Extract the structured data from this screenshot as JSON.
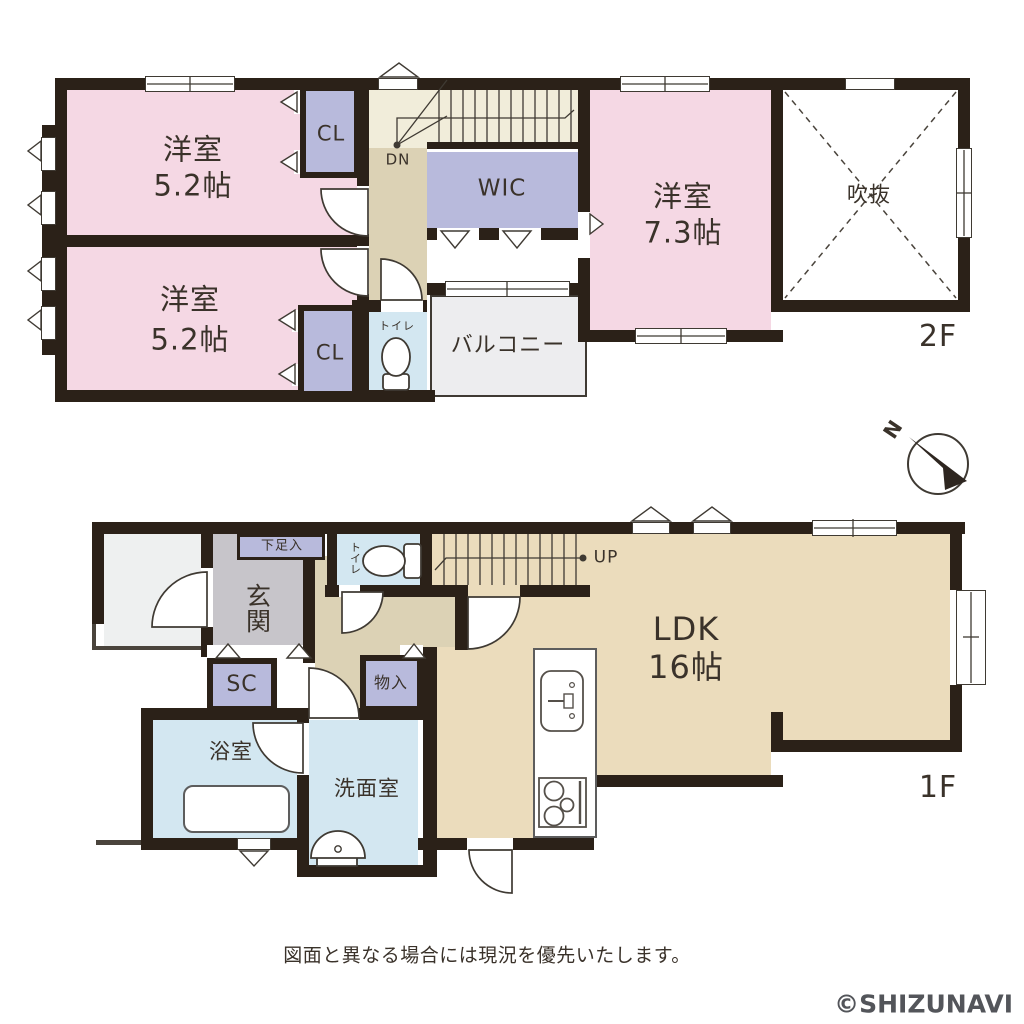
{
  "colors": {
    "wall": "#2b2118",
    "ink": "#3a322a",
    "pink": "#f5d8e4",
    "lavender": "#b8badc",
    "blue": "#d3e7f1",
    "hall_beige": "#dcd2b5",
    "ldk_beige": "#ebdcbc",
    "stair_cream": "#f1edda",
    "genkan_gray": "#c7c5ca",
    "porch_gray": "#eef0f0",
    "balcony_gray": "#ededef",
    "watermark_gray": "#53555a"
  },
  "floor2": {
    "floor_label": "2F",
    "room1": {
      "name": "洋室",
      "size": "5.2帖"
    },
    "room2": {
      "name": "洋室",
      "size": "5.2帖"
    },
    "room3": {
      "name": "洋室",
      "size": "7.3帖"
    },
    "closet1": "CL",
    "closet2": "CL",
    "wic": "WIC",
    "void": "吹抜",
    "balcony": "バルコニー",
    "toilet": "トイレ",
    "stairs": "DN"
  },
  "floor1": {
    "floor_label": "1F",
    "ldk": {
      "name": "LDK",
      "size": "16帖"
    },
    "entrance": "玄関",
    "shoe_cabinet": "下足入",
    "shoe_closet": "SC",
    "toilet": "トイレ",
    "bathroom": "浴室",
    "washroom": "洗面室",
    "storage": "物入",
    "stairs": "UP"
  },
  "compass": {
    "north": "N"
  },
  "footer": {
    "disclaimer": "図面と異なる場合には現況を優先いたします。",
    "watermark": "©SHIZUNAVI"
  }
}
